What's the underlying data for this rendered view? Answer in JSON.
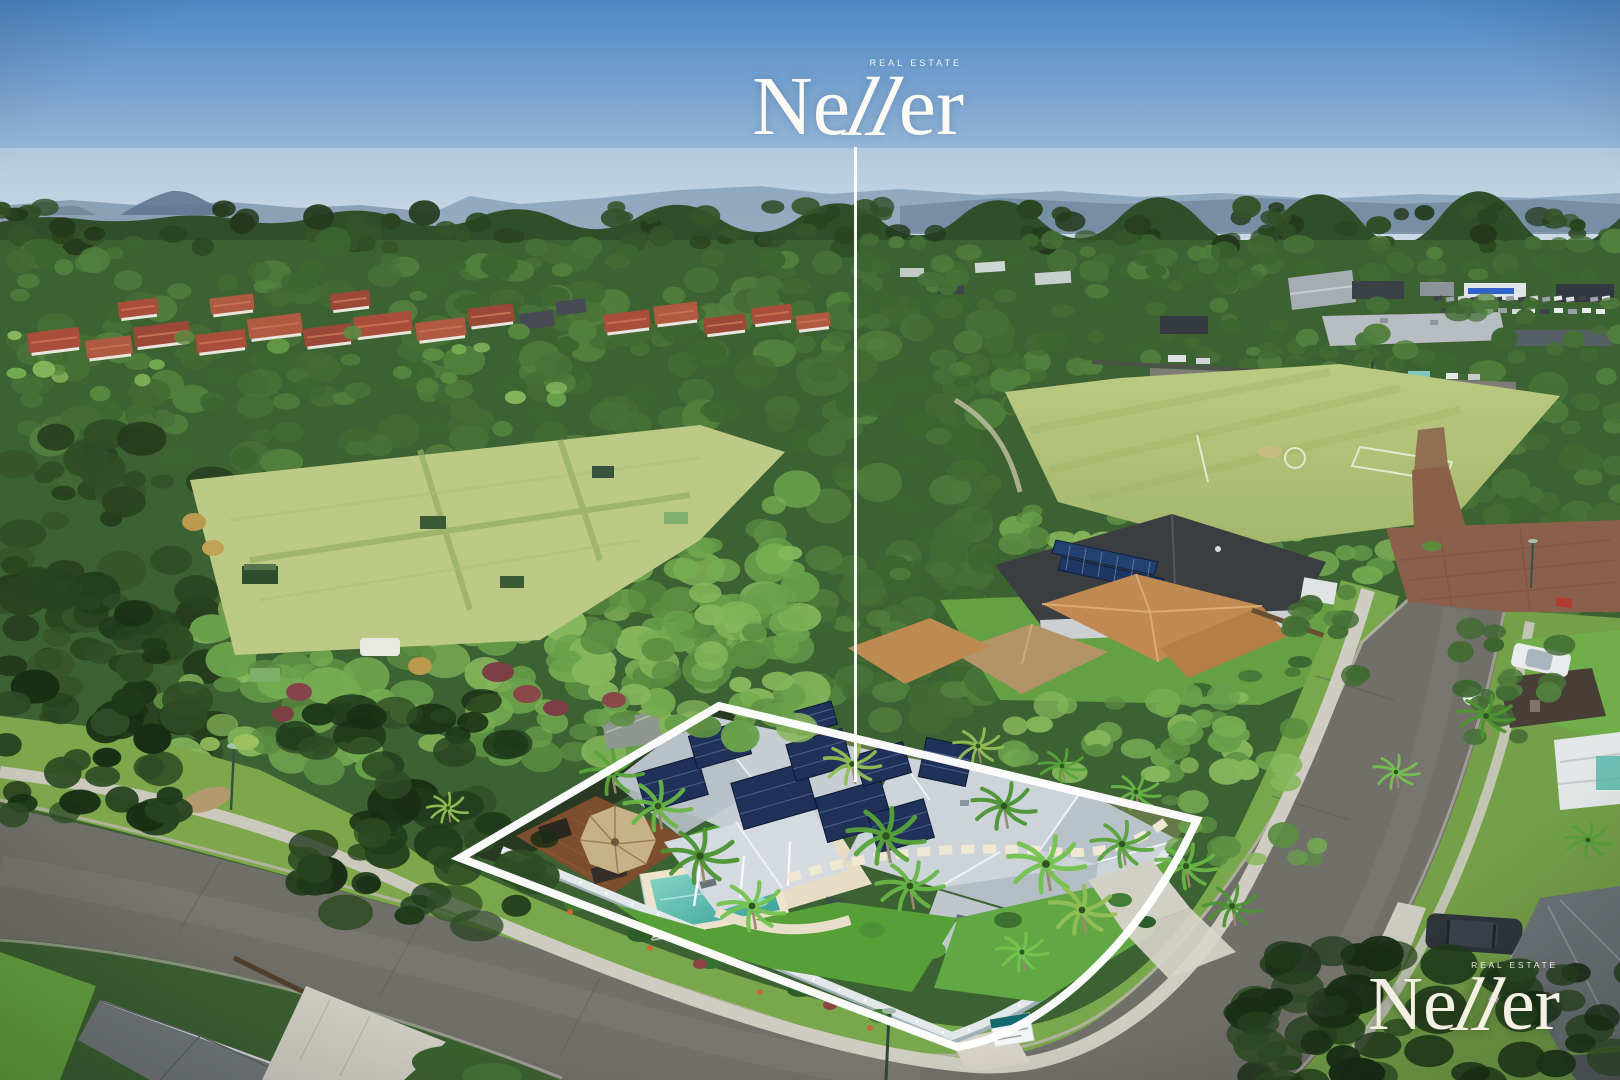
{
  "meta": {
    "description": "Aerial drone photograph of a residential corner property outlined in white, with a pointer line from the agency logo to the house",
    "image_width": 1620,
    "image_height": 1080
  },
  "watermarks": {
    "top": {
      "brand_pre": "Ne",
      "brand_mid": "ll",
      "brand_post": "er",
      "tagline": "REAL ESTATE"
    },
    "bottom": {
      "brand_pre": "Ne",
      "brand_mid": "ll",
      "brand_post": "er",
      "tagline": "REAL ESTATE"
    }
  },
  "overlay": {
    "boundary_color": "#ffffff",
    "pointer_line_color": "#ffffff"
  },
  "scene": {
    "sky_color": "#5b8fc7",
    "forest_color": "#3f6a33",
    "field_color": "#b3c47a",
    "pool_color": "#49b0a6",
    "house_roof_color": "#c9d0d6",
    "road_color": "#706e68",
    "solar_panel_color": "#22335c",
    "terracotta_roof_color": "#a84e3a"
  }
}
